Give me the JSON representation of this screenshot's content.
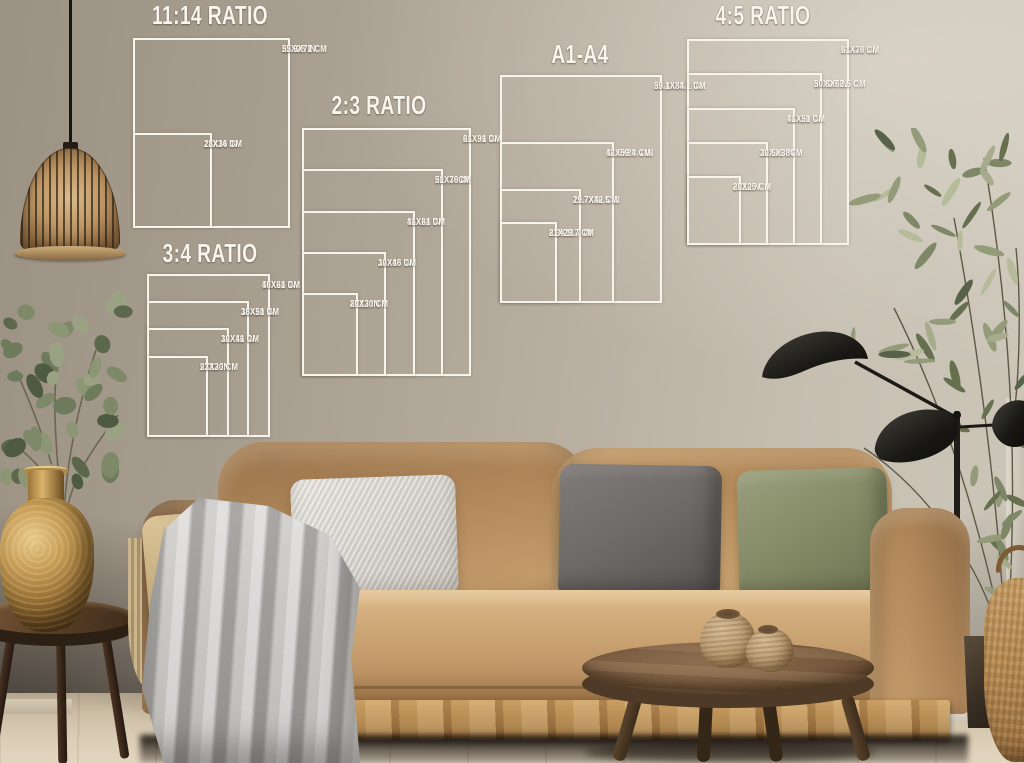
{
  "scene": {
    "overlay_color": "#f7f4ec",
    "colors": {
      "wall": "#b3a999",
      "sofa": "#bf9a6b",
      "seat_cushion": "#c8a172",
      "pillow_white": "#dcdad4",
      "pillow_gray": "#6e6a67",
      "pillow_green": "#8b9070",
      "pillow_beige": "#cdb587",
      "throw_blanket": "#b5b3b0",
      "wood_table": "#715641",
      "gold_vase": "#a8813f",
      "plant_green": "#7c8463",
      "lamp_black": "#1e1c19",
      "floor": "#d7cab4",
      "basket": "#b68a55"
    }
  },
  "size_guides": {
    "groups": [
      {
        "id": "ratio-11-14",
        "title": "11:14 RATIO",
        "title_center_x": 210,
        "title_top": 1,
        "left": 133,
        "bottom": 228,
        "px_per_inch_x": 7.14,
        "px_per_inch_y": 6.79,
        "sizes": [
          {
            "w_in": 22,
            "h_in": 28,
            "label_in": "22X28 IN",
            "label_cm": "55.9X71 CM"
          },
          {
            "w_in": 11,
            "h_in": 14,
            "label_in": "11X14 IN",
            "label_cm": "28X36 CM"
          }
        ]
      },
      {
        "id": "ratio-2-3",
        "title": "2:3 RATIO",
        "title_center_x": 379,
        "title_top": 91,
        "left": 302,
        "bottom": 376,
        "px_per_inch_x": 7.04,
        "px_per_inch_y": 6.89,
        "sizes": [
          {
            "w_in": 24,
            "h_in": 36,
            "label_in": "24X36 IN",
            "label_cm": "61X91 CM"
          },
          {
            "w_in": 20,
            "h_in": 30,
            "label_in": "20X30 IN",
            "label_cm": "51X76CM"
          },
          {
            "w_in": 16,
            "h_in": 24,
            "label_in": "16X24 IN",
            "label_cm": "41X61 CM"
          },
          {
            "w_in": 12,
            "h_in": 18,
            "label_in": "12X18 IN",
            "label_cm": "30X46 CM"
          },
          {
            "w_in": 8,
            "h_in": 12,
            "label_in": "8X12 IN",
            "label_cm": "20X30 CM"
          }
        ]
      },
      {
        "id": "ratio-3-4",
        "title": "3:4 RATIO",
        "title_center_x": 210,
        "title_top": 239,
        "left": 147,
        "bottom": 437,
        "px_per_inch_x": 6.83,
        "px_per_inch_y": 6.79,
        "sizes": [
          {
            "w_in": 18,
            "h_in": 24,
            "label_in": "18X24 IN",
            "label_cm": "46X61 CM"
          },
          {
            "w_in": 15,
            "h_in": 20,
            "label_in": "15X20 IN",
            "label_cm": "38X51 CM"
          },
          {
            "w_in": 12,
            "h_in": 16,
            "label_in": "12X16 IN",
            "label_cm": "30X41 CM"
          },
          {
            "w_in": 9,
            "h_in": 12,
            "label_in": "9X12 IN",
            "label_cm": "23X30 CM"
          }
        ]
      },
      {
        "id": "a1-a4",
        "title": "A1-A4",
        "title_center_x": 580,
        "title_top": 40,
        "left": 500,
        "bottom": 303,
        "px_per_inch_x": 6.92,
        "px_per_inch_y": 6.89,
        "sizes": [
          {
            "w_in": 23.4,
            "h_in": 33.1,
            "label_in": "23.4X33.1 IN",
            "label_cm": "59.1X84.1 CM"
          },
          {
            "w_in": 16.5,
            "h_in": 23.4,
            "label_in": "16.5X23.4 IN",
            "label_cm": "42X59.4 CM"
          },
          {
            "w_in": 11.7,
            "h_in": 16.5,
            "label_in": "11.7X16.5 IN",
            "label_cm": "29.7X42 CM"
          },
          {
            "w_in": 8.3,
            "h_in": 11.7,
            "label_in": "8.3X11.7 IN",
            "label_cm": "21X29.7 CM"
          }
        ]
      },
      {
        "id": "ratio-4-5",
        "title": "4:5 RATIO",
        "title_center_x": 763,
        "title_top": 1,
        "left": 687,
        "bottom": 245,
        "px_per_inch_x": 6.75,
        "px_per_inch_y": 6.87,
        "sizes": [
          {
            "w_in": 24,
            "h_in": 30,
            "label_in": "24X30 IN",
            "label_cm": "61X76 CM"
          },
          {
            "w_in": 20,
            "h_in": 25,
            "label_in": "20X25 IN",
            "label_cm": "50.8X63.5 CM"
          },
          {
            "w_in": 16,
            "h_in": 20,
            "label_in": "16X20 IN",
            "label_cm": "41X51 CM"
          },
          {
            "w_in": 12,
            "h_in": 15,
            "label_in": "12X15 IN",
            "label_cm": "30.5X38CM"
          },
          {
            "w_in": 8,
            "h_in": 10,
            "label_in": "8X10IN",
            "label_cm": "20X25 CM"
          }
        ]
      }
    ]
  }
}
